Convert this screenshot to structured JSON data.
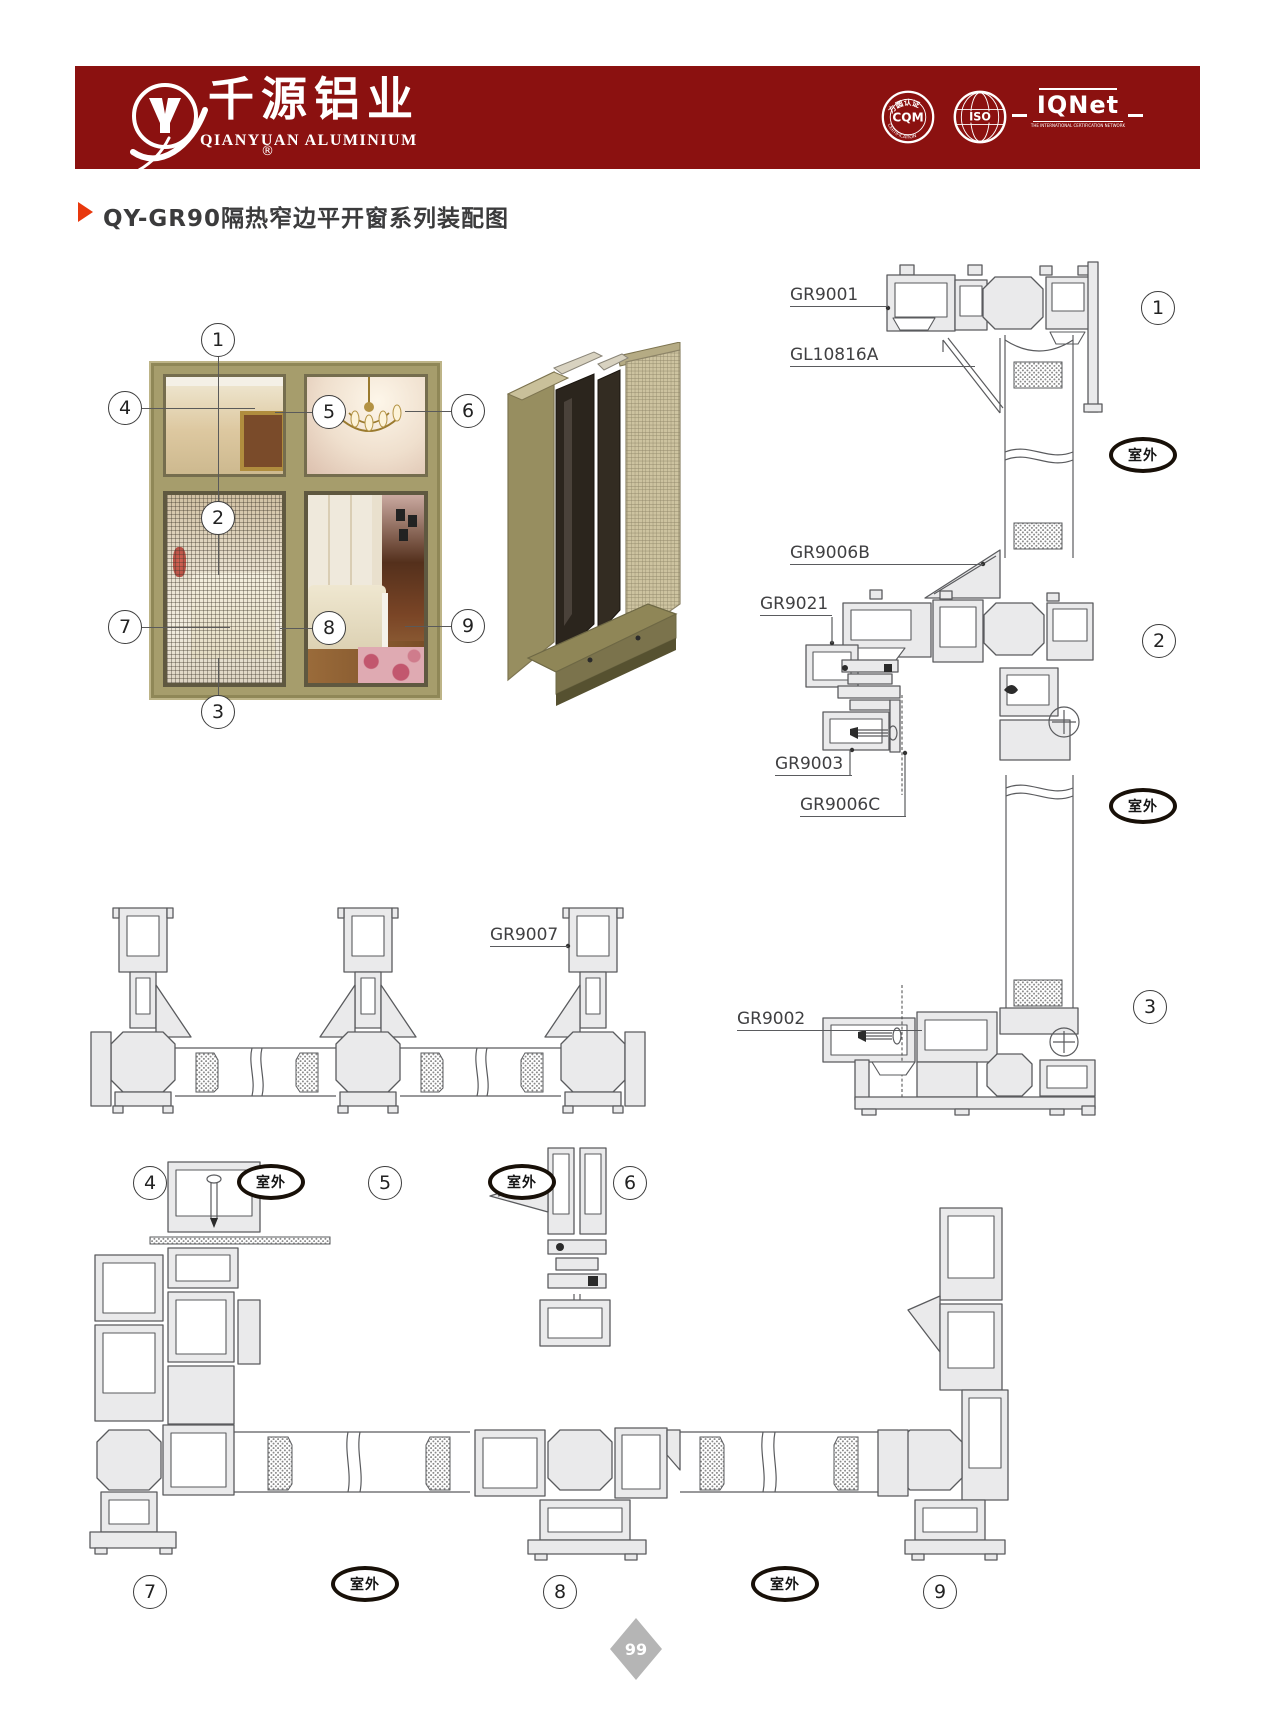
{
  "header": {
    "brand_cn": "千源铝业",
    "brand_en": "QIANYUAN ALUMINIUM",
    "reg_mark": "®",
    "badges": {
      "cqm_arc_top": "方圆认证",
      "cqm_label": "CQM",
      "cqm_arc_bottom": "CERTIFICATION",
      "iso_label": "ISO",
      "iqnet_label": "IQNet",
      "iqnet_sub": "THE INTERNATIONAL CERTIFICATION NETWORK"
    }
  },
  "title": {
    "text": "QY-GR90隔热窄边平开窗系列装配图"
  },
  "markers": [
    "1",
    "2",
    "3",
    "4",
    "5",
    "6",
    "7",
    "8",
    "9"
  ],
  "outdoor_label": "室外",
  "part_labels": {
    "gr9001": "GR9001",
    "gl10816a": "GL10816A",
    "gr9006b": "GR9006B",
    "gr9021": "GR9021",
    "gr9003": "GR9003",
    "gr9006c": "GR9006C",
    "gr9007": "GR9007",
    "gr9002": "GR9002"
  },
  "page": {
    "page_number": "99"
  },
  "palette": {
    "banner_red": "#8b1110",
    "accent_red": "#e8380d",
    "frame_khaki": "#a69d6c",
    "line_gray": "#5a5b5e"
  }
}
